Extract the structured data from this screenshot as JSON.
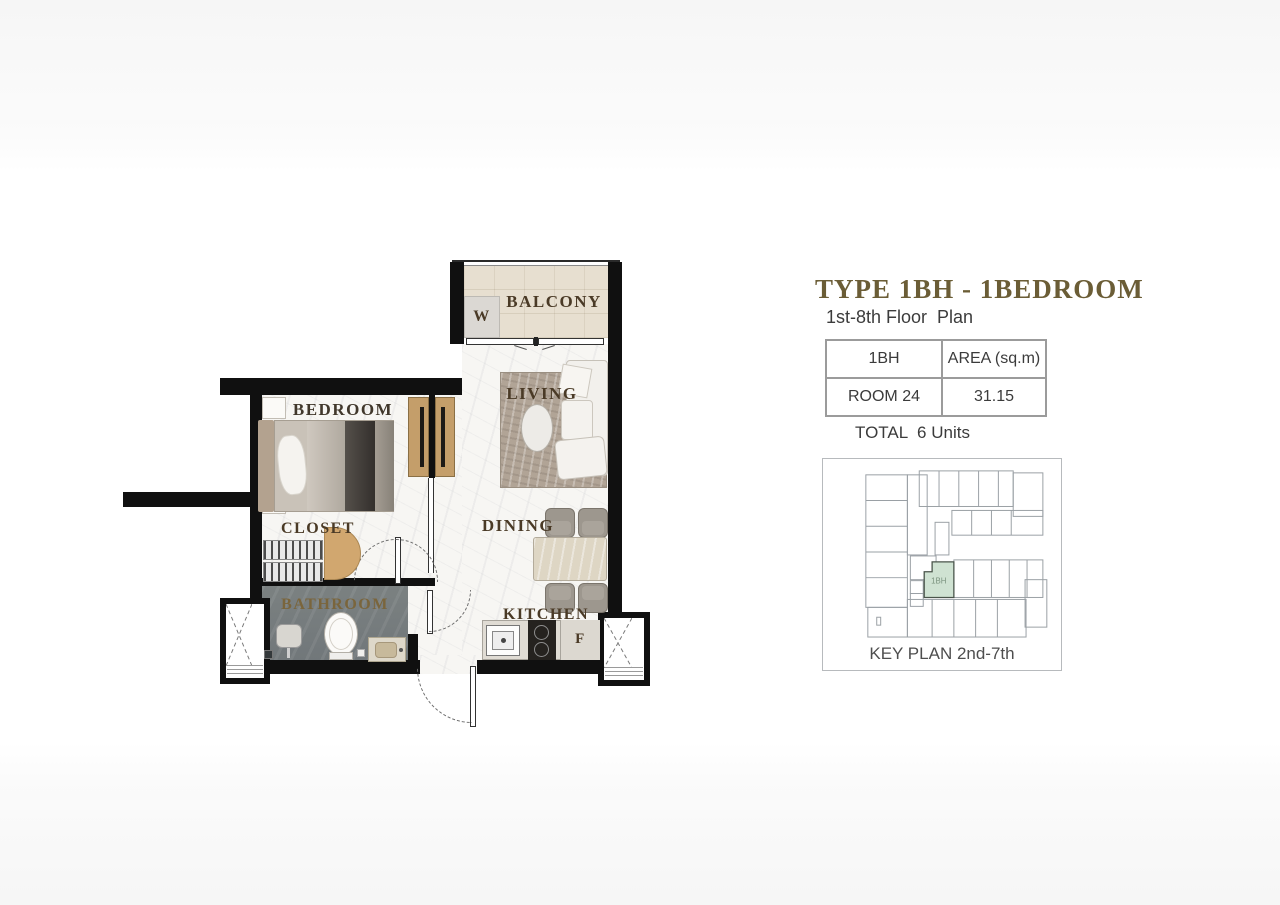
{
  "header": {
    "title": "TYPE 1BH - 1BEDROOM",
    "subtitle": "1st-8th Floor  Plan"
  },
  "info_table": {
    "header_type": "1BH",
    "header_area": "AREA (sq.m)",
    "room": "ROOM 24",
    "area_value": "31.15"
  },
  "total_line": "TOTAL  6 Units",
  "key_plan": {
    "caption": "KEY PLAN 2nd-7th",
    "highlighted_unit": "1BH"
  },
  "floor_plan": {
    "labels": {
      "balcony": "BALCONY",
      "washer": "W",
      "bedroom": "BEDROOM",
      "living": "LIVING",
      "closet": "CLOSET",
      "dining": "DINING",
      "bathroom": "BATHROOM",
      "kitchen": "KITCHEN",
      "fridge": "F"
    }
  },
  "colors": {
    "title": "#6b5d36",
    "room_label": "#4a3a26",
    "bathroom_label": "#7a653c",
    "wall": "#101010",
    "keyplan_highlight": "#cfe2d2"
  }
}
